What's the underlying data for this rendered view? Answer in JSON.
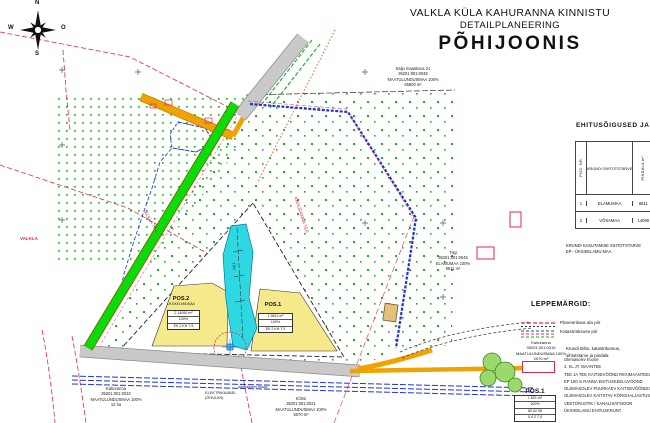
{
  "title": {
    "line1": "VALKLA KÜLA KAHURANNA KINNISTU",
    "line2": "DETAILPLANEERING",
    "line3": "PÕHIJOONIS"
  },
  "compass": {
    "n": "N",
    "s": "S",
    "w": "W",
    "o": "O"
  },
  "ehitus_table": {
    "heading": "EHITUSÕIGUSED JA",
    "col_pos": "POS. NR",
    "col_siht": "KRUNDI SIHTOTSTARVE",
    "col_pindala": "PINDALA m²",
    "col_extra": "EHITUSALA m²",
    "rows": [
      {
        "nr": "1",
        "siht": "ELAMUMAA",
        "pindala": "9811",
        "extra": ""
      },
      {
        "nr": "2",
        "siht": "VÕSAMAA",
        "pindala": "14090",
        "extra": ""
      }
    ],
    "note1": "KRUNDI KASUTAMISE SIHTOTSTARVE",
    "note2": "EP - ÜKSIKELAMU MAA"
  },
  "legend": {
    "heading": "LEPPEMÄRGID:",
    "item1": "Planeeritava ala piir",
    "item2": "Katastriüksuse piir",
    "parcel_block": {
      "l1": "Kahuranna",
      "l2": "35201:001:0015",
      "l3": "MAATULUNDUSMAA 100%",
      "l4": "2070 m²"
    },
    "caption1": "Krundi tähis, katastritunnus,",
    "caption2": "sihtotstarve ja pindala",
    "notes": [
      "Olemasolev hoone",
      "4. KL JT. MAANTEE",
      "TEE JA TEE KAITSEVÖÖND RIIGIMAANTEEL",
      "EP 100 m RANNA EHITUSKEELUVÖÖND",
      "OLEMASOLEV PUURKAEV KAITSEVÖÖNDIGA",
      "OLEMASOLEV KAITSTAV KÕRGHALJASTUS",
      "VEETORUSTIK / KANALISATSIOON",
      "ÜKSIKELAMU EHITUSKRUNT"
    ],
    "pos_sample": {
      "title": "POS.1",
      "rows": [
        "1   821 m²",
        "100%",
        "60  02  08",
        "0,4  2  7,5"
      ]
    }
  },
  "pos1": {
    "title": "POS.1",
    "rows": [
      "1   9811 m²",
      "100%",
      "EK 2  KH 7,5"
    ]
  },
  "pos2": {
    "title": "POS.2",
    "subtitle": "ÜKSIKELAMUMAA",
    "rows": [
      "2   14090 m²",
      "100%",
      "EK 2  KH 7,5"
    ]
  },
  "map_labels": {
    "top_parcel": {
      "l1": "Kalju maaüksus 21",
      "l2": "35201:001:0046",
      "l3": "MAATULUNDUSMAA 100%",
      "l4": "65800 m²"
    },
    "right_parcel": {
      "l1": "Tiigi",
      "l2": "35201:001:0045",
      "l3": "ELAMUMAA 100%",
      "l4": "9811 m²"
    },
    "bottom_parcel": {
      "l1": "Kõrtsi",
      "l2": "35201:001:0021",
      "l3": "MAATULUNDUSMAA 100%",
      "l4": "5070 m²"
    },
    "bottomleft_parcel": {
      "l1": "Kahuranna",
      "l2": "35201:001:0010",
      "l3": "MAATULUNDUSMAA 100%",
      "l4": "12 ha"
    },
    "elektrikaabel1": "ELEKTRIKAABEL",
    "elektrikaabel2": "(ÕHULIIN)",
    "kraav": "olemasolev kraav",
    "road_corridor": "KAHURANNA TEE",
    "road_strip": "VALKLA TEE",
    "left_edge": "VALKLA",
    "pond": "TIIK"
  },
  "colors": {
    "boundary_red": "#e02850",
    "vegetation_green": "#1fae1f",
    "road_orange": "#f0a300",
    "road_gray": "#c6c6c6",
    "strip_green": "#08dd08",
    "utility_blue": "#2233cc",
    "pond_cyan": "#2fd8e0",
    "parcel_yellow": "#f5e98c"
  }
}
